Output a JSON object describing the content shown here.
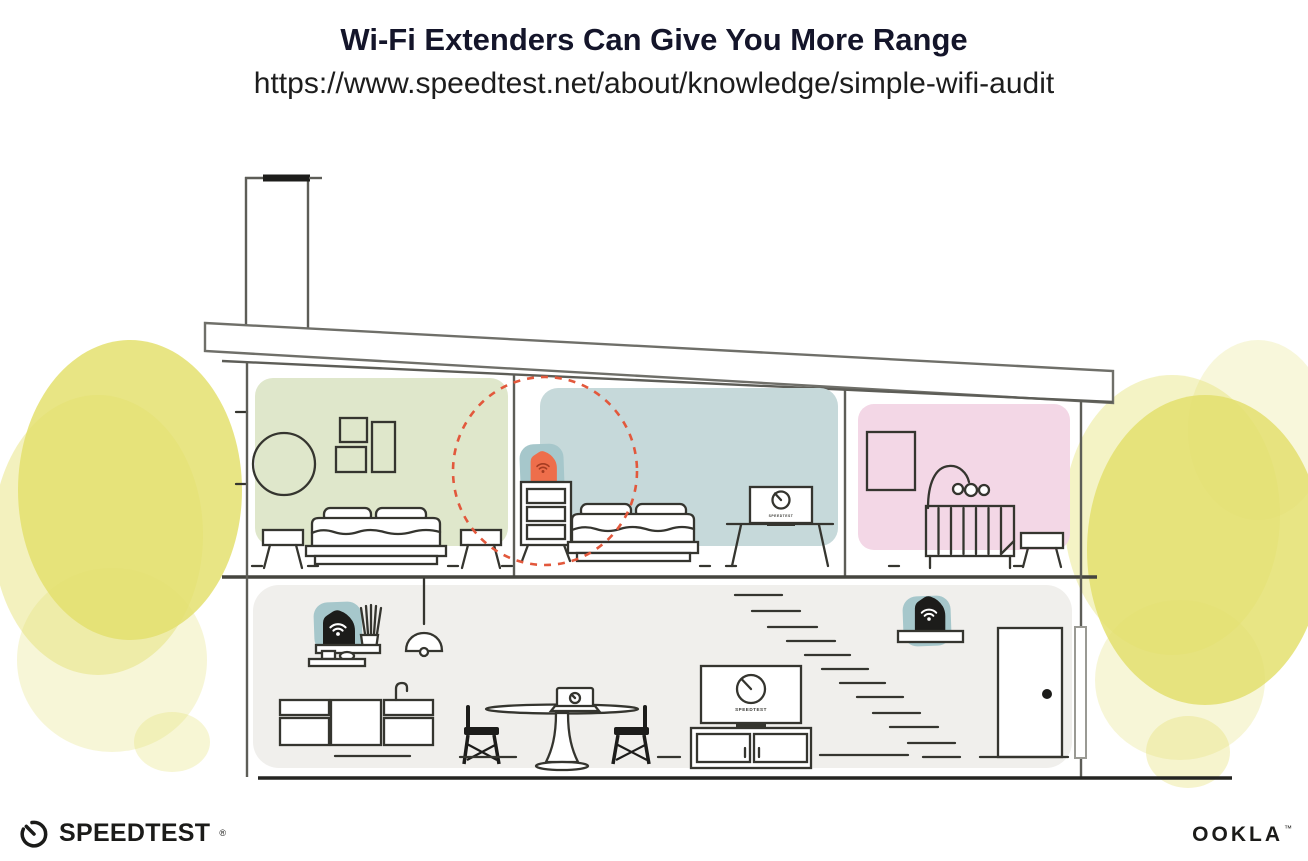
{
  "header": {
    "title": "Wi-Fi Extenders Can Give You More Range",
    "url": "https://www.speedtest.net/about/knowledge/simple-wifi-audit"
  },
  "branding": {
    "speedtest_text": "SPEEDTEST",
    "speedtest_mark": "®",
    "ookla_text": "OOKLA",
    "ookla_mark": "™"
  },
  "screens": {
    "tv_label": "SPEEDTEST"
  },
  "illustration": {
    "scene": "Cross-section of a two-story house showing Wi-Fi router and extender coverage",
    "devices": [
      {
        "id": "extender-upstairs-bedroom",
        "type": "wifi-extender",
        "location": "on dresser in middle upstairs bedroom",
        "accent_color": "#ee6e4b",
        "coverage_highlighted": true
      },
      {
        "id": "router-living-room",
        "type": "wifi-router",
        "location": "on wall shelf in living area",
        "accent_color": "#1c1c1a",
        "coverage_highlighted": false
      },
      {
        "id": "extender-near-stairs",
        "type": "wifi-extender",
        "location": "on shelf above the stairs",
        "accent_color": "#1c1c1a",
        "coverage_highlighted": false
      }
    ],
    "rooms": [
      {
        "id": "bedroom-left",
        "color": "#dfe7cb"
      },
      {
        "id": "bedroom-middle",
        "color": "#c6d9da"
      },
      {
        "id": "nursery",
        "color": "#f3d7e6"
      },
      {
        "id": "ground-floor-living-area",
        "color": "#f0efec"
      }
    ],
    "colors": {
      "device_pad_teal": "#a6c7cb",
      "extender_orange": "#ee6e4b",
      "coverage_dash_red": "#e2583c",
      "foliage_yellow": "#e4e06f",
      "furniture_line": "#35352f",
      "structure_line": "#5d5d57",
      "title_navy": "#14152a"
    }
  }
}
